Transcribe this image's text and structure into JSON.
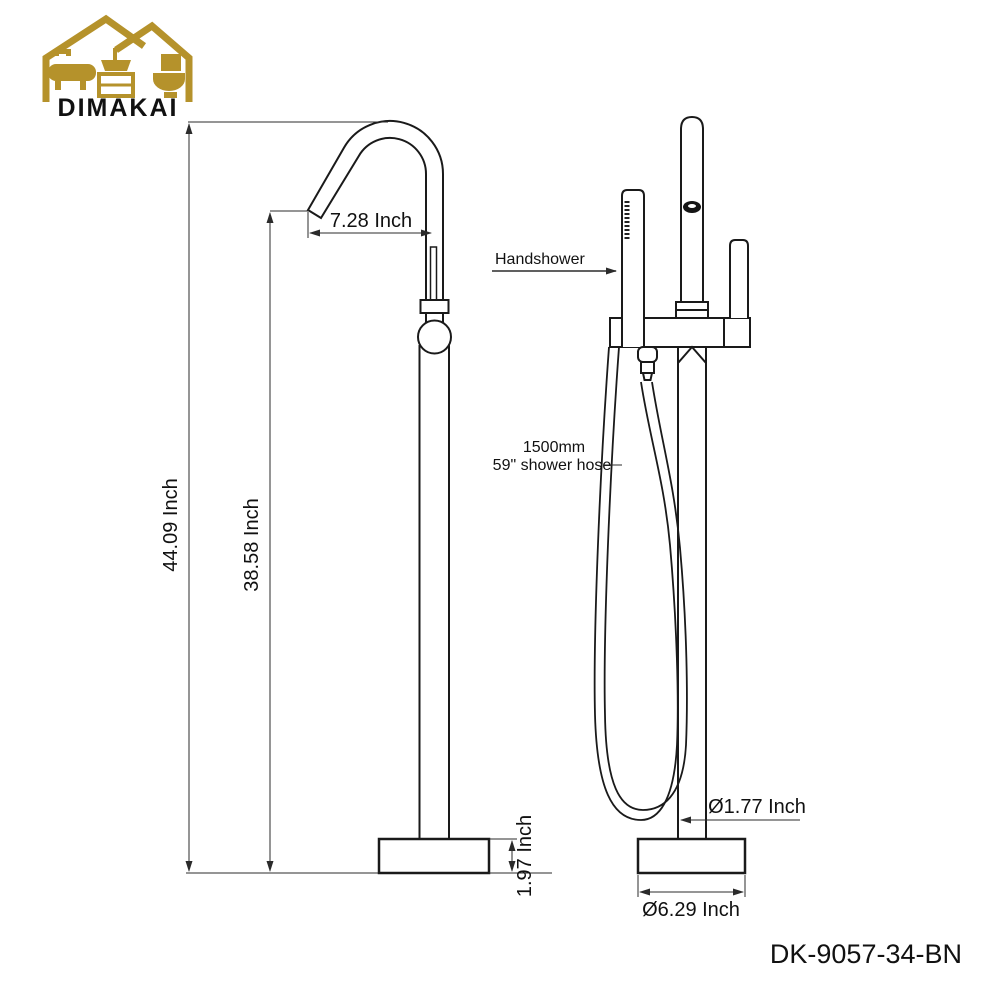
{
  "brand": {
    "name": "DIMAKAI"
  },
  "product_code": "DK-9057-34-BN",
  "colors": {
    "logo_gold": "#B5922B",
    "line": "#1A1A1A",
    "dim_line": "#2B2B2B",
    "text": "#111111",
    "background": "#FFFFFF"
  },
  "side_view": {
    "dim_spout_reach": "7.28 Inch",
    "dim_total_height": "44.09 Inch",
    "dim_spout_height": "38.58 Inch",
    "dim_base_height": "1.97 Inch"
  },
  "front_view": {
    "label_handshower": "Handshower",
    "label_hose_mm": "1500mm",
    "label_hose_inch": "59\" shower hose",
    "dim_column_diameter": "Ø1.77 Inch",
    "dim_base_diameter": "Ø6.29 Inch"
  }
}
